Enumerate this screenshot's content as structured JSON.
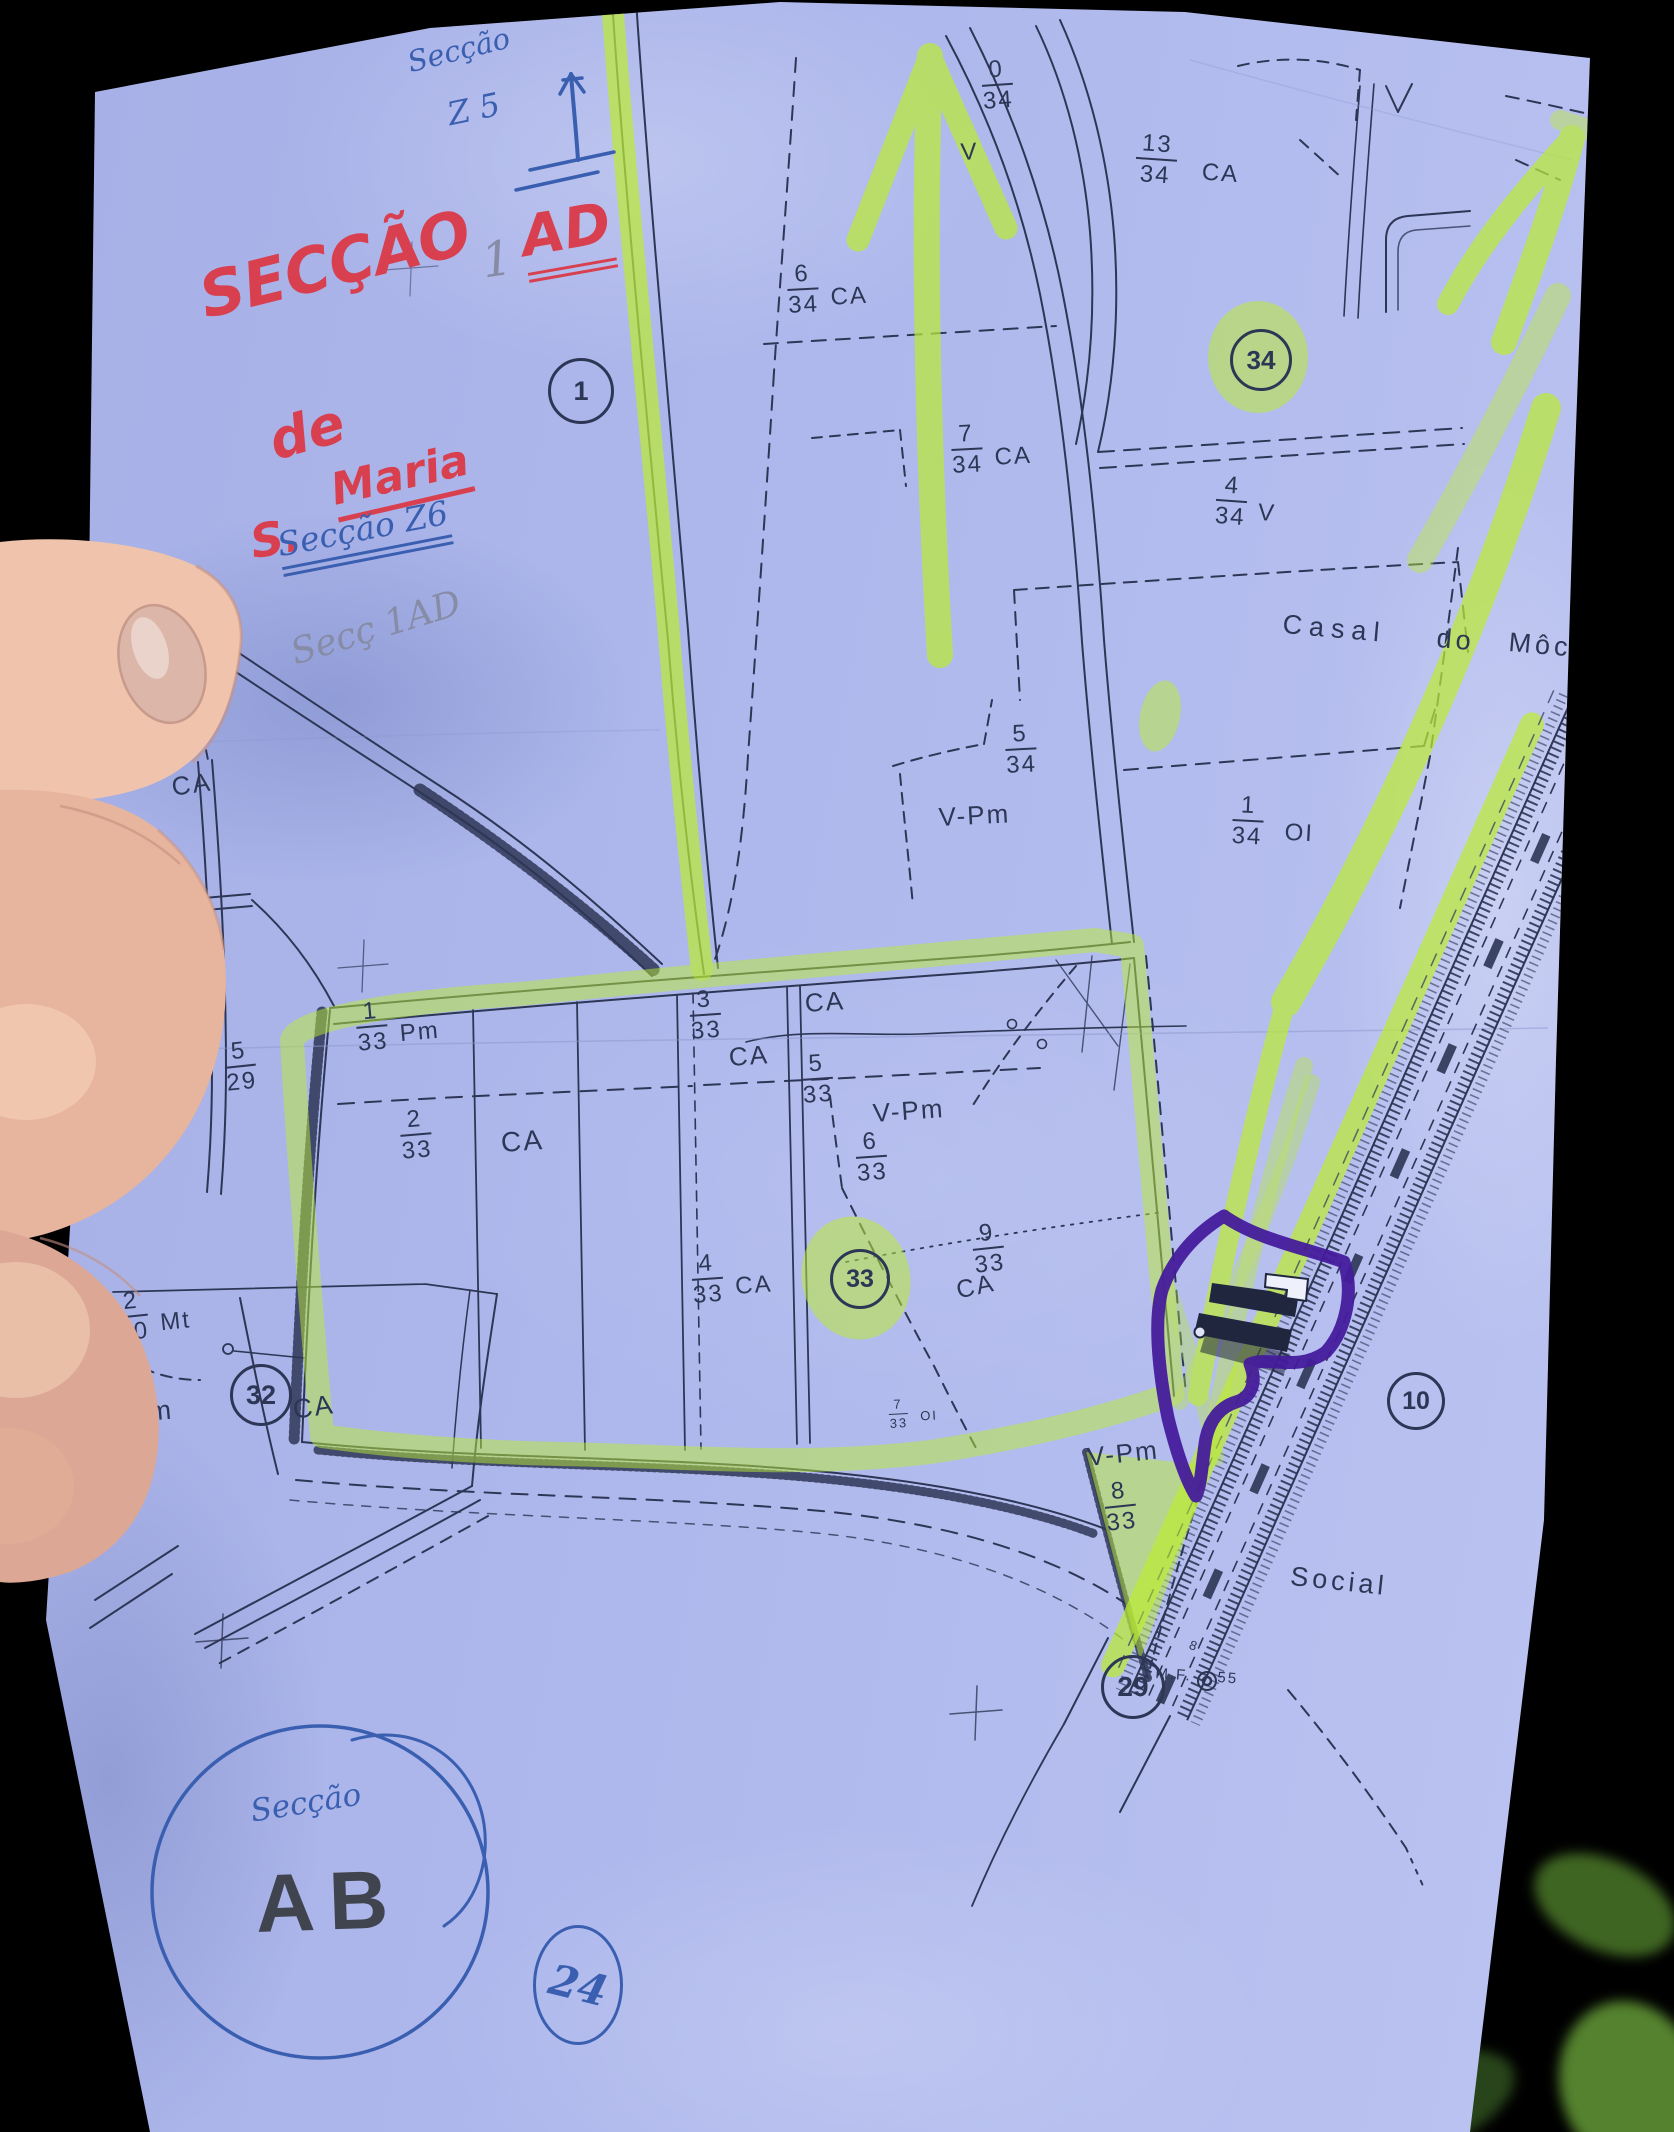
{
  "scene": {
    "description": "photo of hand holding cadastral map sheet",
    "width": 1674,
    "height": 2132
  },
  "colors": {
    "paper": "#aeb8ec",
    "ink": "#2e3656",
    "highlighter": "#bceb35",
    "purple_marker": "#451b9c",
    "red_pen": "#d8404f",
    "blue_pen": "#3a5fb0",
    "pencil": "#868ca6",
    "stamp": "#40444e",
    "skin": "#eec2ab"
  },
  "handwritten_annotations": [
    {
      "id": "seccao-z5-word",
      "text": "Secção",
      "color": "blue",
      "x": 404,
      "y": 46,
      "size": 29,
      "rot": -14
    },
    {
      "id": "seccao-z5-code",
      "text": "Z 5",
      "color": "blue",
      "x": 444,
      "y": 96,
      "size": 32,
      "rot": -12
    },
    {
      "id": "seccao-red",
      "text": "SECÇÃO",
      "color": "red",
      "x": 192,
      "y": 262,
      "size": 62,
      "rot": -14
    },
    {
      "id": "ad-red",
      "text": "AD",
      "color": "red",
      "x": 516,
      "y": 206,
      "size": 56,
      "rot": -10,
      "underline": "double"
    },
    {
      "id": "pencil-1",
      "text": "1",
      "color": "pencil",
      "x": 478,
      "y": 234,
      "size": 48,
      "rot": -8
    },
    {
      "id": "de-red",
      "text": "de",
      "color": "red",
      "x": 262,
      "y": 412,
      "size": 54,
      "rot": -16
    },
    {
      "id": "s-red",
      "text": "S.",
      "color": "red",
      "x": 246,
      "y": 516,
      "size": 46,
      "rot": -10
    },
    {
      "id": "maria-red",
      "text": "Maria",
      "color": "red",
      "x": 326,
      "y": 466,
      "size": 44,
      "rot": -13,
      "underline": "solid"
    },
    {
      "id": "seccao-z6",
      "text": "Secção Z6",
      "color": "blue",
      "x": 274,
      "y": 526,
      "size": 33,
      "rot": -11,
      "underline": "double"
    },
    {
      "id": "secc-1ad",
      "text": "Secç  1AD",
      "color": "pencil",
      "x": 286,
      "y": 634,
      "size": 36,
      "rot": -17
    },
    {
      "id": "seccao-ab-script",
      "text": "Secção",
      "color": "blue",
      "x": 248,
      "y": 1794,
      "size": 31,
      "rot": -9
    },
    {
      "id": "ab-stamp",
      "text": "AB",
      "color": "stamp",
      "x": 254,
      "y": 1858,
      "size": 82,
      "rot": -2,
      "ls": 14
    }
  ],
  "circled_numbers": [
    {
      "text": "1",
      "x": 578,
      "y": 388,
      "rx": 30,
      "ry": 30,
      "color": "ink",
      "fs": 27
    },
    {
      "text": "34",
      "x": 1258,
      "y": 357,
      "rx": 28,
      "ry": 28,
      "color": "ink",
      "fs": 26
    },
    {
      "text": "33",
      "x": 857,
      "y": 1276,
      "rx": 27,
      "ry": 27,
      "color": "ink",
      "fs": 25
    },
    {
      "text": "32",
      "x": 258,
      "y": 1392,
      "rx": 28,
      "ry": 28,
      "color": "ink",
      "fs": 27
    },
    {
      "text": "10",
      "x": 1413,
      "y": 1398,
      "rx": 26,
      "ry": 26,
      "color": "ink",
      "fs": 25
    },
    {
      "text": "29",
      "x": 1130,
      "y": 1684,
      "rx": 29,
      "ry": 29,
      "color": "ink",
      "fs": 28
    },
    {
      "text": "24",
      "x": 575,
      "y": 1982,
      "rx": 42,
      "ry": 57,
      "color": "blue",
      "fs": 42,
      "trot": 14
    }
  ],
  "parcel_fractions": [
    {
      "num": "0",
      "den": "34",
      "x": 980,
      "y": 58,
      "rot": -4
    },
    {
      "num": "13",
      "den": "34",
      "suffix": "CA",
      "x": 1138,
      "y": 130,
      "rot": 4,
      "gap": 26
    },
    {
      "num": "6",
      "den": "34",
      "suffix": "CA",
      "x": 786,
      "y": 262,
      "rot": -3
    },
    {
      "num": "7",
      "den": "34",
      "suffix": "CA",
      "x": 950,
      "y": 422,
      "rot": -3
    },
    {
      "num": "4",
      "den": "34",
      "suffix": "V",
      "x": 1218,
      "y": 472,
      "rot": 4
    },
    {
      "num": "5",
      "den": "34",
      "x": 1004,
      "y": 722,
      "rot": -3
    },
    {
      "num": "1",
      "den": "34",
      "suffix": "OI",
      "x": 1234,
      "y": 792,
      "rot": 3,
      "gap": 22
    },
    {
      "num": "5",
      "den": "14",
      "x": 158,
      "y": 692,
      "rot": -8
    },
    {
      "num": "5",
      "den": "29",
      "x": 222,
      "y": 1040,
      "rot": -6
    },
    {
      "num": "1",
      "den": "33",
      "suffix": "Pm",
      "x": 354,
      "y": 1000,
      "rot": -5
    },
    {
      "num": "2",
      "den": "33",
      "x": 398,
      "y": 1108,
      "rot": -5
    },
    {
      "num": "3",
      "den": "33",
      "x": 688,
      "y": 988,
      "rot": -4
    },
    {
      "num": "5",
      "den": "33",
      "x": 800,
      "y": 1052,
      "rot": -4
    },
    {
      "num": "6",
      "den": "33",
      "x": 854,
      "y": 1130,
      "rot": -4
    },
    {
      "num": "4",
      "den": "33",
      "suffix": "CA",
      "x": 690,
      "y": 1252,
      "rot": -4
    },
    {
      "num": "9",
      "den": "33",
      "x": 970,
      "y": 1222,
      "rot": -6
    },
    {
      "num": "7",
      "den": "33",
      "suffix": "OI",
      "x": 888,
      "y": 1398,
      "rot": -3,
      "small": true
    },
    {
      "num": "8",
      "den": "33",
      "x": 1102,
      "y": 1480,
      "rot": -6
    },
    {
      "num": "2",
      "den": "30",
      "suffix": "Mt",
      "x": 114,
      "y": 1290,
      "rot": -6
    },
    {
      "num": "1",
      "den": "30",
      "x": 106,
      "y": 1442,
      "rot": -6
    }
  ],
  "area_labels": [
    {
      "text": "V",
      "x": 960,
      "y": 140,
      "size": 24,
      "rot": -3
    },
    {
      "text": "CA",
      "x": 170,
      "y": 774,
      "size": 26,
      "rot": -8
    },
    {
      "text": "CA",
      "x": 500,
      "y": 1128,
      "size": 28,
      "rot": -4
    },
    {
      "text": "CA",
      "x": 804,
      "y": 990,
      "size": 26,
      "rot": -4
    },
    {
      "text": "CA",
      "x": 728,
      "y": 1044,
      "size": 26,
      "rot": -4
    },
    {
      "text": "V-Pm",
      "x": 938,
      "y": 804,
      "size": 26,
      "rot": -3
    },
    {
      "text": "V-Pm",
      "x": 872,
      "y": 1100,
      "size": 26,
      "rot": -4
    },
    {
      "text": "CA",
      "x": 954,
      "y": 1278,
      "size": 25,
      "rot": -12
    },
    {
      "text": "V-Pm",
      "x": 98,
      "y": 1402,
      "size": 27,
      "rot": -5
    },
    {
      "text": "CA",
      "x": 291,
      "y": 1396,
      "size": 27,
      "rot": -8
    },
    {
      "text": "V-Pm",
      "x": 1086,
      "y": 1444,
      "size": 26,
      "rot": -6
    },
    {
      "text": "Casal",
      "x": 1284,
      "y": 610,
      "size": 27,
      "rot": 5,
      "ls": 7
    },
    {
      "text": "do",
      "x": 1438,
      "y": 624,
      "size": 27,
      "rot": 5,
      "ls": 4
    },
    {
      "text": "Môch",
      "x": 1510,
      "y": 628,
      "size": 27,
      "rot": 5,
      "ls": 4
    },
    {
      "text": "Social",
      "x": 1292,
      "y": 1562,
      "size": 27,
      "rot": 6,
      "ls": 4
    },
    {
      "text": "M.F.",
      "x": 1156,
      "y": 1666,
      "size": 15,
      "rot": 4
    },
    {
      "text": "55",
      "x": 1218,
      "y": 1670,
      "size": 15,
      "rot": 4
    },
    {
      "text": "8",
      "x": 1192,
      "y": 1638,
      "size": 13,
      "rot": 20
    }
  ]
}
